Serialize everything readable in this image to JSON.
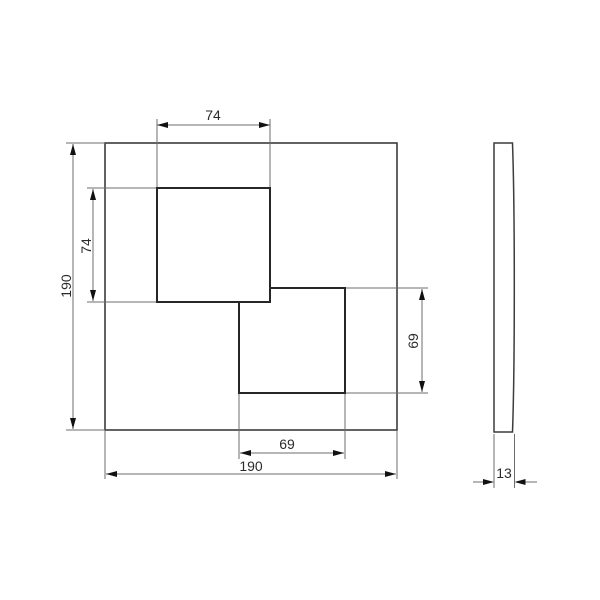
{
  "drawing": {
    "type": "technical-dimension-drawing",
    "views": {
      "front": {
        "plate": {
          "width_mm": "190",
          "height_mm": "190"
        },
        "upper_square": {
          "width_mm": "74",
          "height_mm": "74"
        },
        "lower_square": {
          "width_mm": "69",
          "height_mm": "69"
        }
      },
      "side": {
        "depth_mm": "13"
      }
    },
    "labels": {
      "top_width": "74",
      "left_inner_height": "74",
      "left_overall_height": "190",
      "right_inner_height": "69",
      "bottom_inner_width": "69",
      "bottom_overall_width": "190",
      "side_depth": "13"
    },
    "colors": {
      "object_line": "#3c3c3c",
      "inner_square_line": "#262626",
      "dimension_line": "#6e6e6e",
      "arrow": "#111111",
      "text": "#2b2b2b",
      "background": "#ffffff"
    }
  }
}
